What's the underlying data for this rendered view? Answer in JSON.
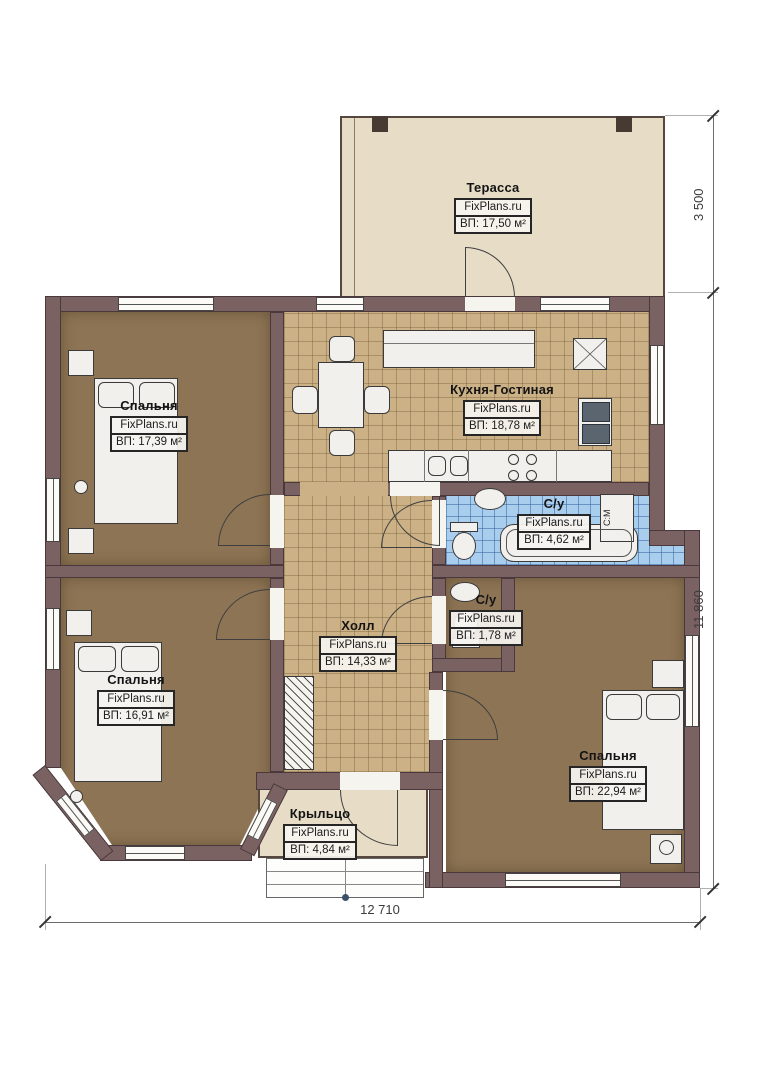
{
  "plan_title": "Одноэтажный дом — план этажа",
  "brand": "FixPlans.ru",
  "rooms": [
    {
      "id": "terrace",
      "name": "Терасса",
      "brand": "FixPlans.ru",
      "area": "ВП: 17,50 м²"
    },
    {
      "id": "bedroom1",
      "name": "Спальня",
      "brand": "FixPlans.ru",
      "area": "ВП: 17,39 м²"
    },
    {
      "id": "kitchen",
      "name": "Кухня-Гостиная",
      "brand": "FixPlans.ru",
      "area": "ВП: 18,78 м²"
    },
    {
      "id": "bath1",
      "name": "С/у",
      "brand": "FixPlans.ru",
      "area": "ВП: 4,62 м²"
    },
    {
      "id": "bath2",
      "name": "С/у",
      "brand": "FixPlans.ru",
      "area": "ВП: 1,78 м²"
    },
    {
      "id": "hall",
      "name": "Холл",
      "brand": "FixPlans.ru",
      "area": "ВП: 14,33 м²"
    },
    {
      "id": "bedroom2",
      "name": "Спальня",
      "brand": "FixPlans.ru",
      "area": "ВП: 16,91 м²"
    },
    {
      "id": "bedroom3",
      "name": "Спальня",
      "brand": "FixPlans.ru",
      "area": "ВП: 22,94 м²"
    },
    {
      "id": "porch",
      "name": "Крыльцо",
      "brand": "FixPlans.ru",
      "area": "ВП: 4,84 м²"
    }
  ],
  "dimensions": {
    "terrace_depth": "3 500",
    "house_depth": "11 860",
    "house_width": "12 710"
  },
  "appliances": {
    "washing_machine": "С:М"
  },
  "colors": {
    "wall": "#7a6263",
    "tile_tan": "#ccb186",
    "tile_blue": "#a9cdec",
    "floor_brown": "#8d7454",
    "deck_beige": "#e7ddc7"
  }
}
